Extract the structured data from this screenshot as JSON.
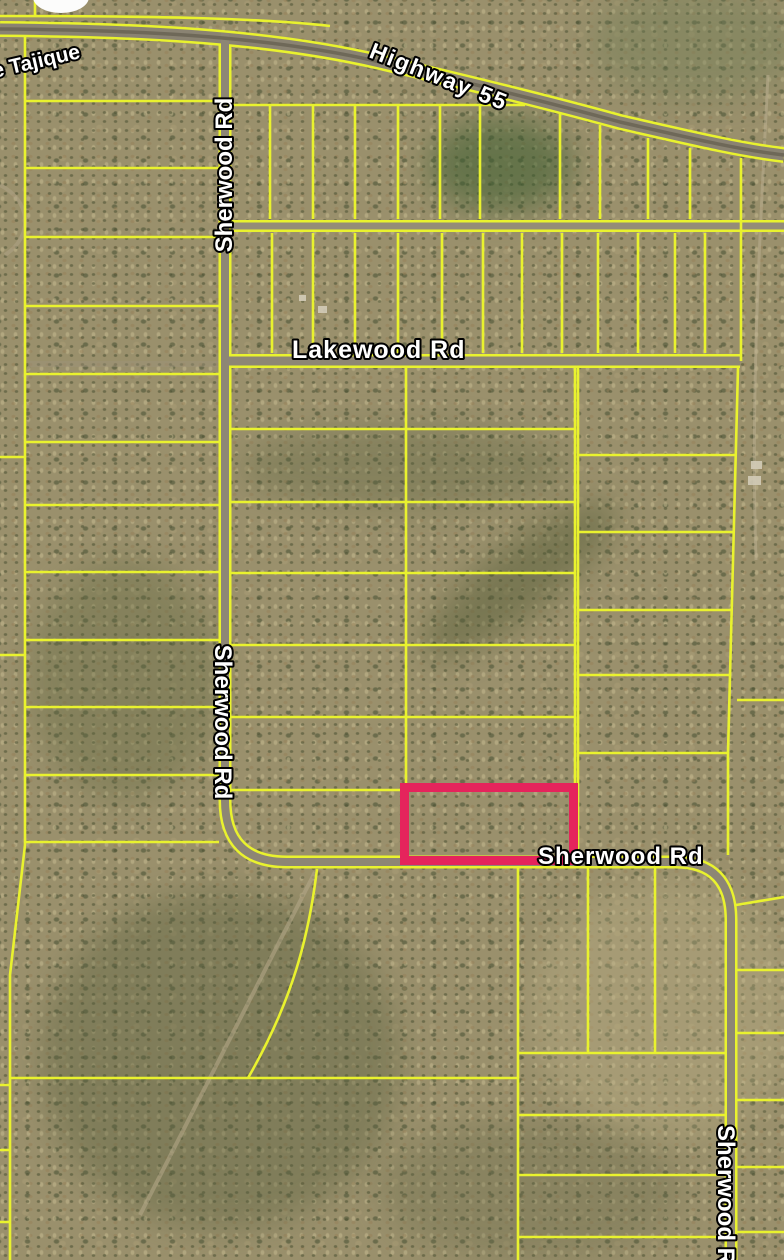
{
  "map": {
    "type": "satellite-parcel-map",
    "colors": {
      "parcel_line": "#e9f22e",
      "highlight_outline": "#e5245c",
      "label_text": "#ffffff",
      "label_outline": "#000000",
      "road_surface": "#8d8675"
    },
    "road_labels": {
      "tajique": "e Tajique",
      "highway_55": "Highway 55",
      "sherwood_rd_top": "Sherwood Rd",
      "lakewood_rd": "Lakewood Rd",
      "sherwood_rd_mid": "Sherwood Rd",
      "sherwood_rd_bottom": "Sherwood Rd",
      "sherwood_rd_right": "Sherwood Rd"
    }
  }
}
